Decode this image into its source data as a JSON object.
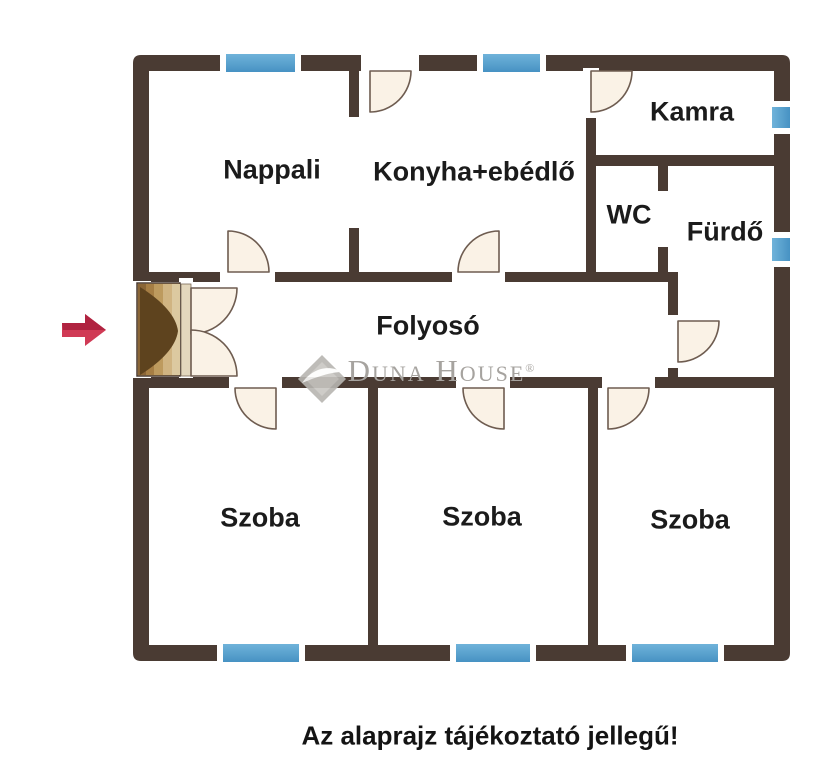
{
  "floorplan": {
    "rooms": [
      {
        "label": "Nappali"
      },
      {
        "label": "Konyha+ebédlő"
      },
      {
        "label": "Kamra"
      },
      {
        "label": "WC"
      },
      {
        "label": "Fürdő"
      },
      {
        "label": "Folyosó"
      },
      {
        "label": "Szoba"
      },
      {
        "label": "Szoba"
      },
      {
        "label": "Szoba"
      }
    ],
    "colors": {
      "wall": "#4a3b33",
      "window_blue": "#4f9fce",
      "door_fill": "#faf2e6",
      "door_outline": "#6e5c50",
      "entrance_arrow": "#c62b45",
      "entrance_wood": "#b98c50"
    },
    "icons": {
      "entrance_arrow": "right-arrow"
    }
  },
  "watermark": {
    "brand": "Duna House",
    "registered": "®"
  },
  "caption": {
    "text": "Az alaprajz tájékoztató jellegű!"
  }
}
